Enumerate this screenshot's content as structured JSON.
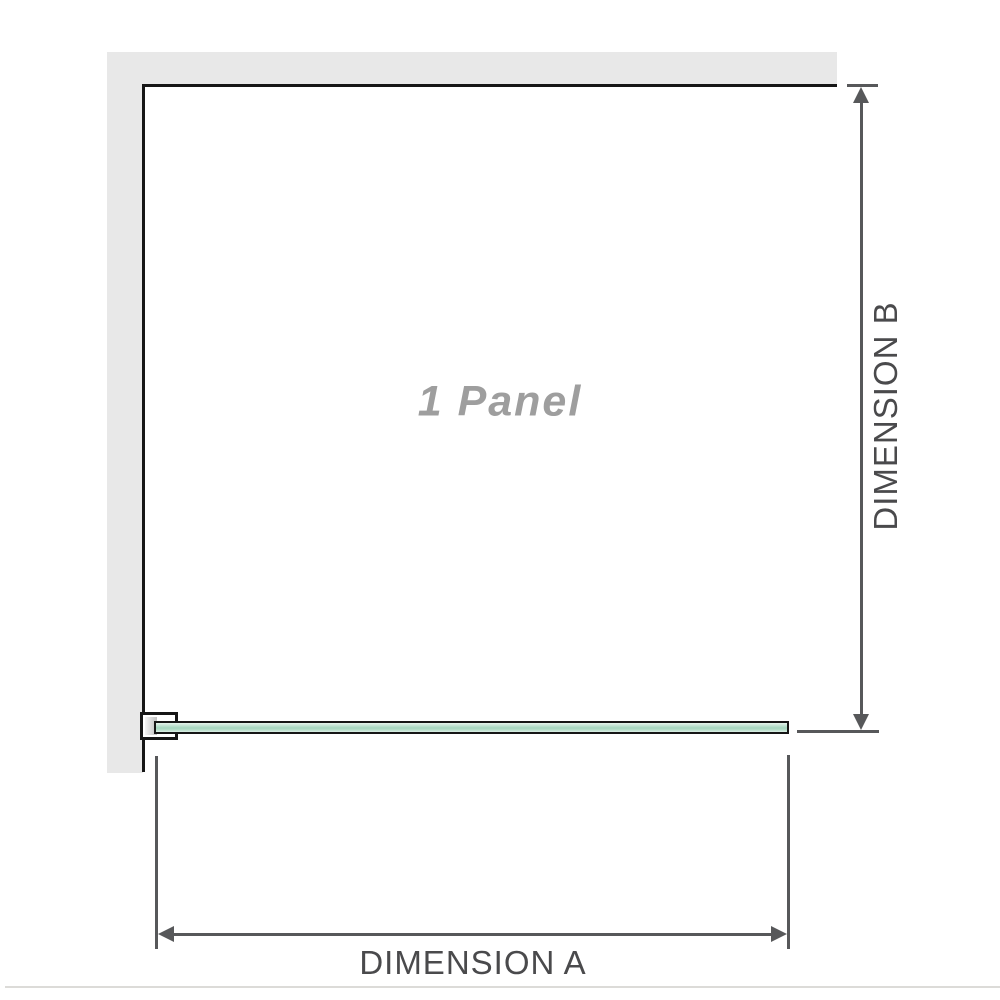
{
  "diagram": {
    "panel_label": "1 Panel",
    "panel_count": 1,
    "dimensions": {
      "a_label": "DIMENSION A",
      "b_label": "DIMENSION B"
    },
    "legend": {
      "glass_panel": "glass-panel",
      "wall": "wall",
      "wall_bracket": "wall-bracket"
    },
    "colors": {
      "background": "#ffffff",
      "wall_fill": "#e8e8e8",
      "panel_outline": "#161616",
      "dimension_line": "#57585a",
      "dimension_text": "#4a4a4c",
      "panel_text": "#9e9e9e",
      "glass_green_mid": "#a4d6be",
      "glass_green_light": "#e6f3ec",
      "baseline": "#dcdbd8"
    }
  }
}
